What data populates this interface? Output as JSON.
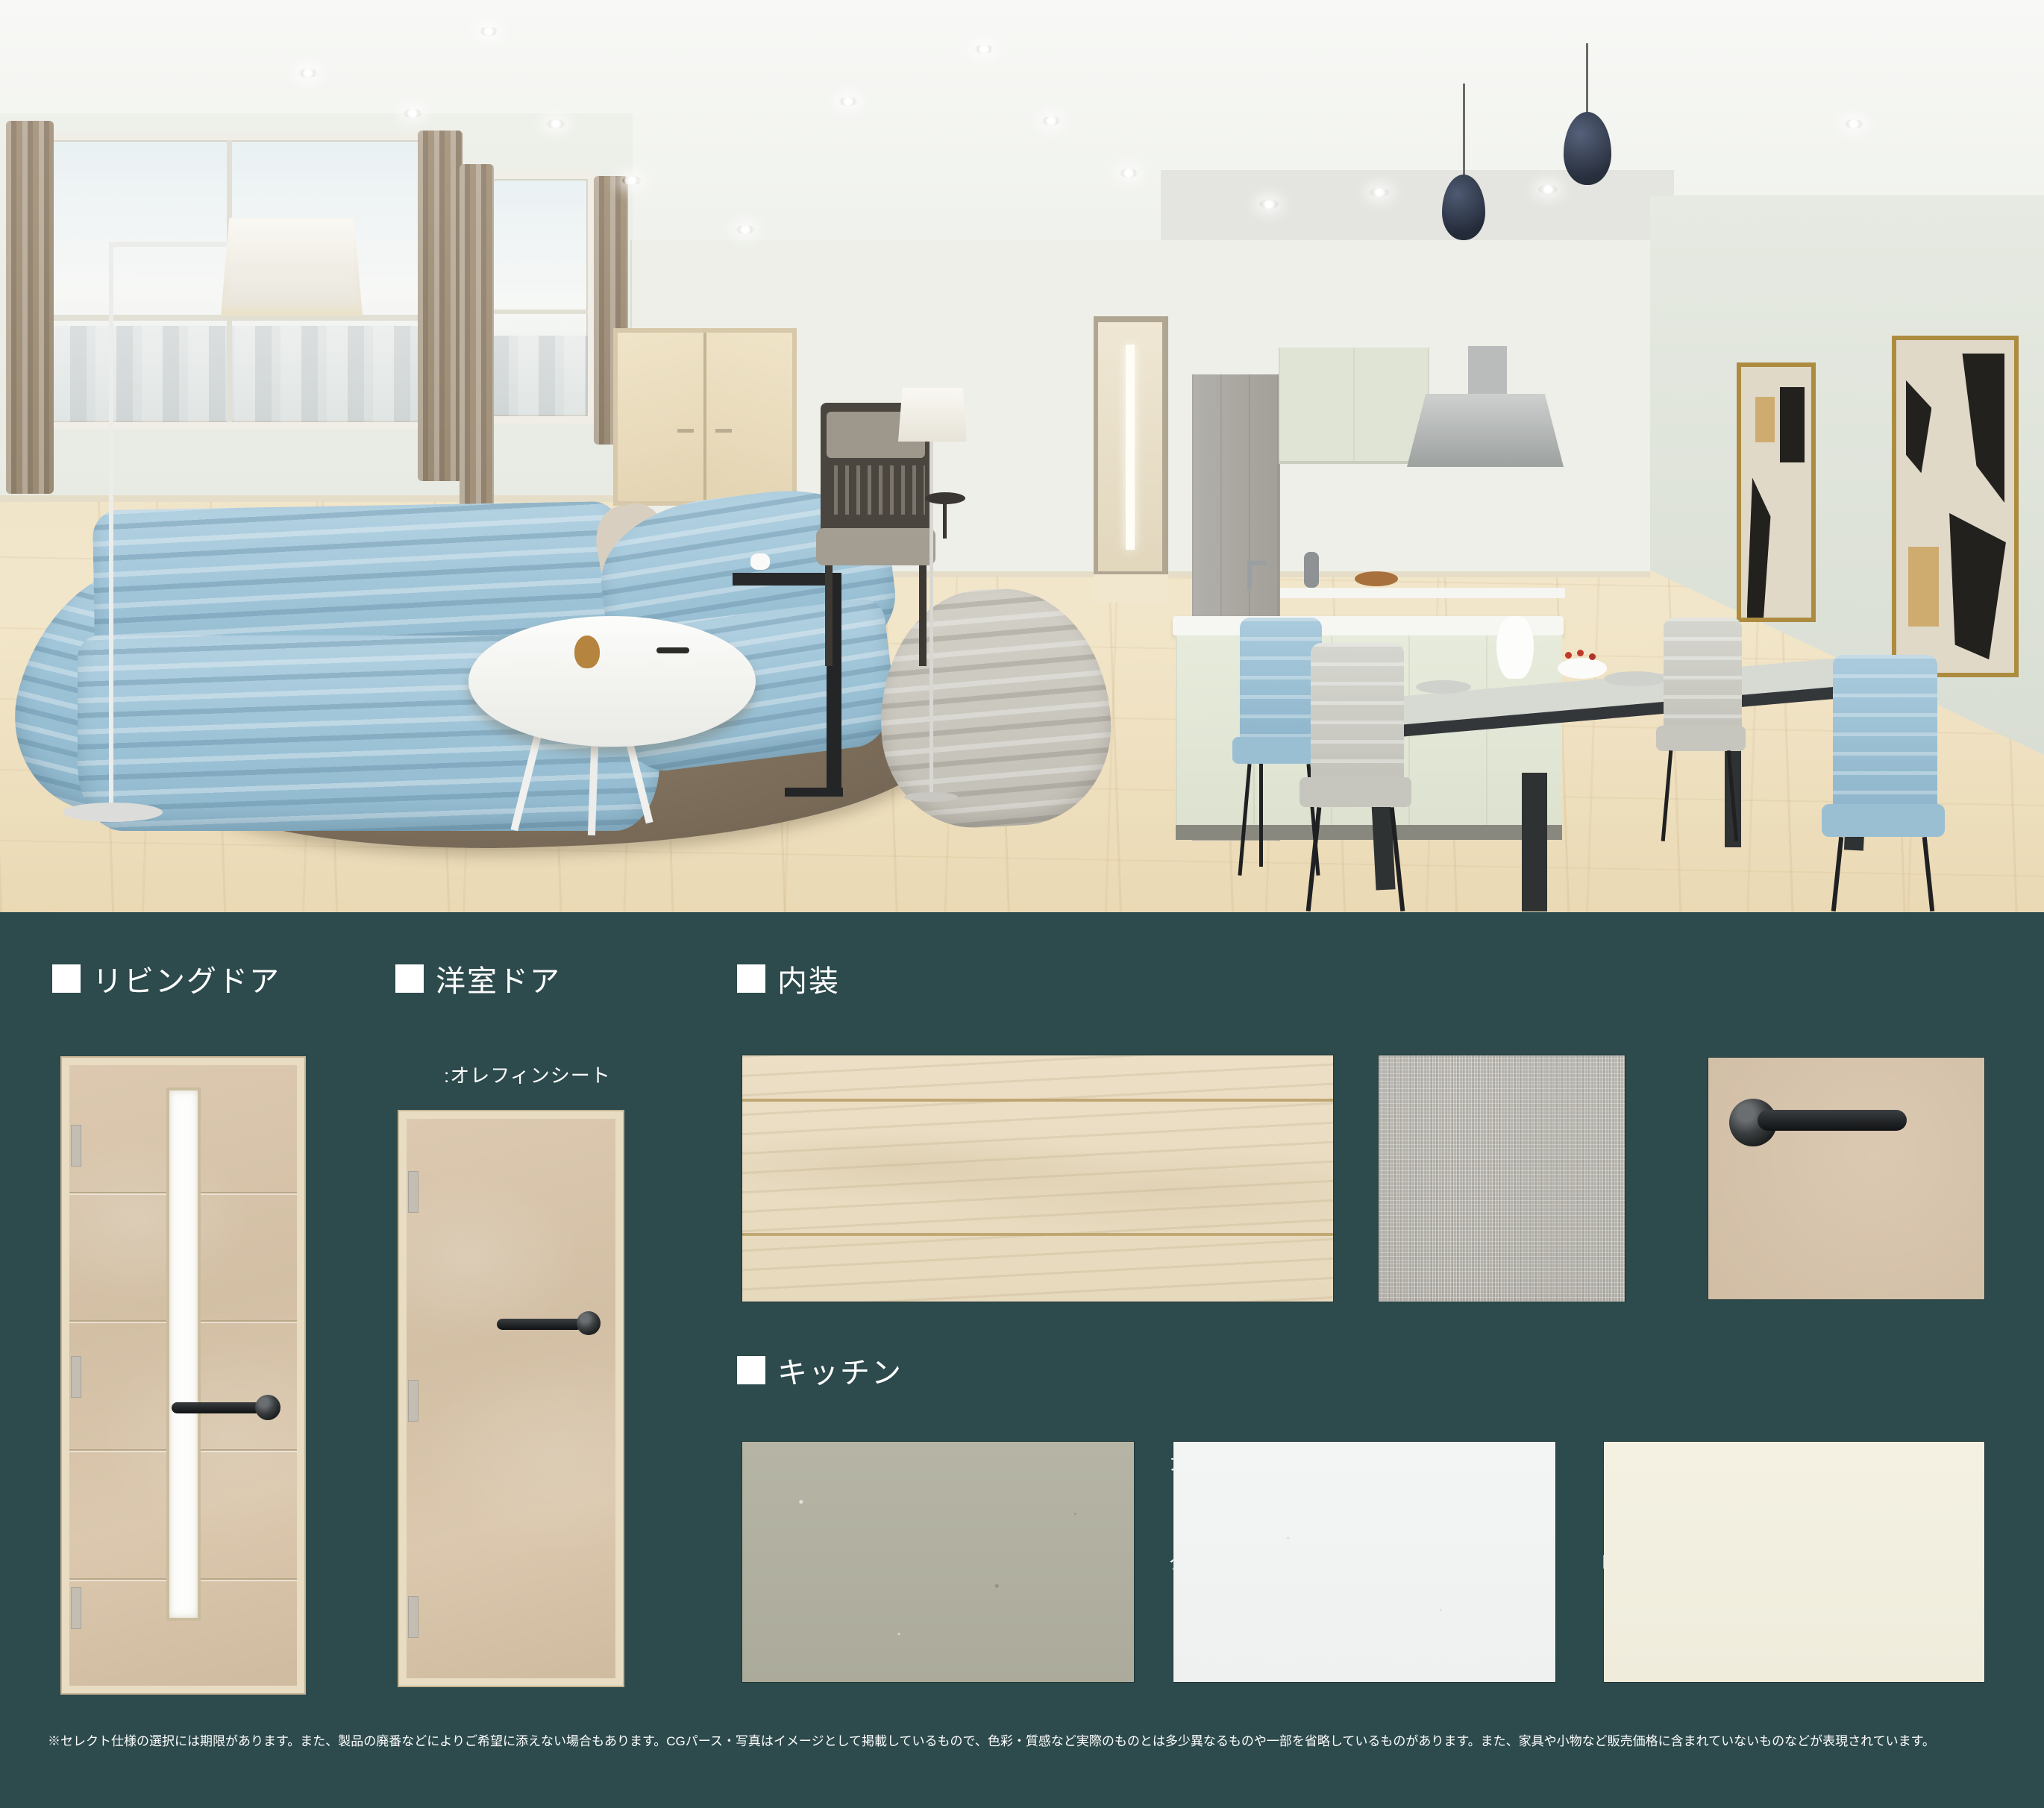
{
  "colors": {
    "panel_background": "#2d4a4c",
    "text": "#ffffff",
    "door_beige": "#d6c3ab",
    "sofa_blue": "#a4c7da",
    "art_frame_gold": "#ad8c3f"
  },
  "sections": {
    "living_door": {
      "title": "リビングドア",
      "sub1": ":オレフィンシート",
      "sub2": "TE-SN7105"
    },
    "bedroom_door": {
      "title": "洋室ドア",
      "sub1": ":オレフィンシート",
      "sub2": "TE-SN7105"
    },
    "interior": {
      "title": "内装",
      "items": [
        {
          "line1": "床:フローリング",
          "line2": "TFP-SN558 ブランチェスナットG"
        },
        {
          "line1": "壁:アクセントクロス",
          "line2": "RE55139"
        },
        {
          "line1": "ドア取手:レバーハンドルTJ",
          "line2": "1-TJC-C003-LJ"
        }
      ]
    },
    "kitchen": {
      "title": "キッチン",
      "items": [
        {
          "line1": "扉:メラミン化粧パネル",
          "line2": "JC-10348K"
        },
        {
          "line1": "カウンタートップ:人造大理石",
          "line2": "グランドホワイト"
        },
        {
          "line1": "キッチンパネル:不燃マグネット",
          "line2": "HNBライトベージュ"
        }
      ]
    }
  },
  "footer": {
    "disclaimer": "※セレクト仕様の選択には期限があります。また、製品の廃番などによりご希望に添えない場合もあります。CGパース・写真はイメージとして掲載しているもので、色彩・質感など実際のものとは多少異なるものや一部を省略しているものがあります。また、家具や小物など販売価格に含まれていないものなどが表現されています。"
  }
}
